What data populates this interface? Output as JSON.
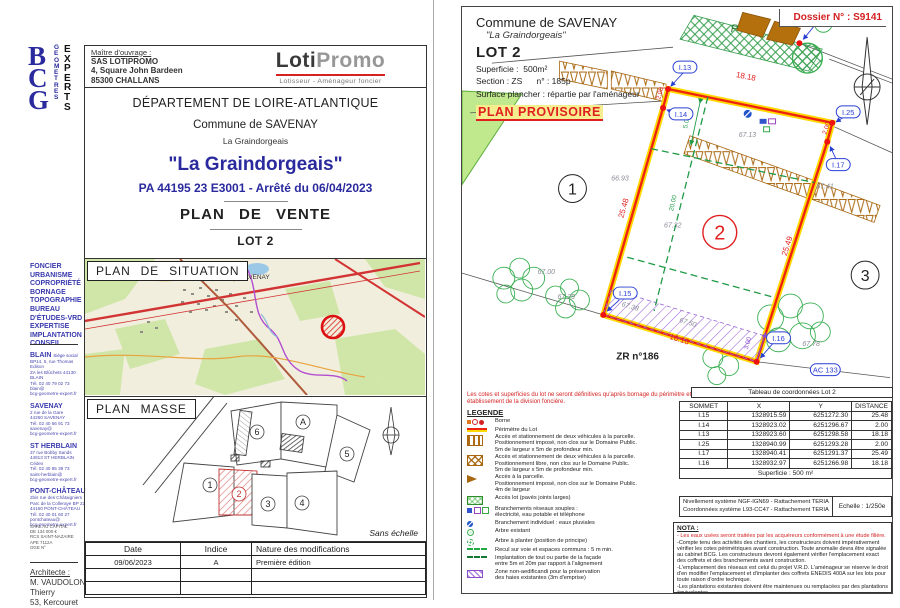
{
  "colors": {
    "accent_blue": "#2a2a9e",
    "red": "#d42222",
    "boundary_red": "#ee2211",
    "boundary_yellow": "#ffd900",
    "green": "#22a04a",
    "purple": "#8a4fc8",
    "brown": "#a8660f"
  },
  "left_page": {
    "logo": {
      "letters": "BCG",
      "geometres": "GEOMETRES",
      "experts": "EXPERTS"
    },
    "owner": {
      "label": "Maître d'ouvrage :",
      "lines": "SAS LOTIPROMO\n4, Square John Bardeen\n85300 CHALLANS"
    },
    "lotipromo": {
      "name_bold": "Loti",
      "name_light": "Promo",
      "tagline": "Lotisseur - Aménageur foncier"
    },
    "title": {
      "departement": "DÉPARTEMENT DE LOIRE-ATLANTIQUE",
      "commune": "Commune de SAVENAY",
      "lieu": "La Graindorgeais",
      "project": "\"La Graindorgeais\"",
      "permit": "PA 44195 23 E3001 - Arrêté du 06/04/2023",
      "doc_type": "PLAN DE VENTE",
      "lot": "LOT 2"
    },
    "situation": {
      "title": "PLAN DE SITUATION",
      "map_label": "SAVENAY"
    },
    "masse": {
      "title": "PLAN MASSE",
      "scale_note": "Sans échelle",
      "lot_numbers": [
        "1",
        "2",
        "3",
        "4",
        "5",
        "6",
        "A"
      ]
    },
    "mod_table": {
      "headers": [
        "Date",
        "Indice",
        "Nature des modifications"
      ],
      "rows": [
        [
          "09/06/2023",
          "A",
          "Première édition"
        ],
        [
          "",
          "",
          ""
        ],
        [
          "",
          "",
          ""
        ]
      ]
    },
    "sidebar": {
      "services": "FONCIER\nURBANISME\nCOPROPRIÉTÉ\nBORNAGE\nTOPOGRAPHIE\nBUREAU\n D'ÉTUDES-VRD\nEXPERTISE\nIMPLANTATION\nCONSEIL",
      "offices": [
        {
          "city": "BLAIN",
          "sub": "Siège social",
          "lines": "BP14, 5, rue Thomas Edison\nZA les Blûchets 44130 BLAIN\nTél. 02 40 79 02 73\nblain@\nbcg-geometre-expert.fr"
        },
        {
          "city": "SAVENAY",
          "sub": "",
          "lines": "2 rue de la Gare\n44260 SAVENAY\nTél. 02 40 56 91 73\nsavenay@\nbcg-geometre-expert.fr"
        },
        {
          "city": "ST HERBLAIN",
          "sub": "",
          "lines": "37 rue Bobby Sands\n44813 ST HERBLAIN Cédex\nTél. 02 40 95 39 73\nsaint-herblain@\nbcg-geometre-expert.fr"
        },
        {
          "city": "PONT-CHÂTEAU",
          "sub": "",
          "lines": "2bis rue des Châtaigniers\nParc de la Colleraye BP 22\n44160 PONT-CHÂTEAU\nTél. 02 40 01 60 27\npontchateau@\nbcg-geometre-expert.fr"
        }
      ],
      "legal": "SARL AU CAPITAL\nDE 134 000 €\nRCS SAINT-NAZAIRE\nAPE 7112A\nOGE N°",
      "architect": {
        "label": "Architecte :",
        "name": "M. VAUDOLON Thierry",
        "address": "53, Kercouret"
      }
    }
  },
  "right_page": {
    "dossier": "Dossier N° : S9141",
    "header": {
      "commune": "Commune de SAVENAY",
      "lieu": "\"La Graindorgeais\"",
      "lot": "LOT 2",
      "superficie": "Superficie :  500m²",
      "section": "Section : ZS      n° : 185p",
      "surface": "Surface plancher : répartie par l'aménageur",
      "provisoire": "PLAN PROVISOIRE"
    },
    "plan": {
      "labels": {
        "i3": "I.3",
        "i13": "I.13",
        "i14": "I.14",
        "i15": "I.15",
        "i16": "I.16",
        "i17": "I.17",
        "i25": "I.25",
        "zr": "ZR n°186",
        "ac": "AC 133",
        "p": "P",
        "lot1": "1",
        "lot2": "2",
        "lot3": "3"
      },
      "dims": {
        "top": "18.18",
        "left": "25.48",
        "right": "25.49",
        "bottom": "18.18",
        "small_left": "2.00",
        "small_right": "2.00",
        "recul": "5.00",
        "depth": "20.00",
        "hedge": "3.00"
      },
      "elev": {
        "lot1": "66.93",
        "top": "67.13",
        "mid": "67.32",
        "left1": "67.00",
        "left2": "67.29",
        "right1": "67.41",
        "right2": "67.78",
        "strip1": "67.38",
        "strip2": "67.50"
      }
    },
    "note_red": "Les cotes et superficies du lot ne seront définitives qu'après bornage du périmètre et établissement de la division foncière.",
    "legend": {
      "title": "LEGENDE",
      "items": [
        {
          "text": "Borne"
        },
        {
          "text": "Périmètre du Lot"
        },
        {
          "text": "Accès et stationnement de deux véhicules à la parcelle.\nPositionnement imposé, non clos sur le Domaine Public.\n5m de largeur x 5m de profondeur min."
        },
        {
          "text": "Accès et stationnement de deux véhicules à la parcelle.\nPositionnement libre, non clos sur le Domaine Public.\n5m de largeur x 5m de profondeur min."
        },
        {
          "text": "Accès à la parcelle.\nPositionnement imposé, non clos sur le Domaine Public.\n4m de largeur"
        },
        {
          "text": "Accès lot (pavés joints larges)"
        },
        {
          "text": "Branchements réseaux souples :\nélectricité, eau potable et téléphone"
        },
        {
          "text": "Branchement individuel : eaux pluviales"
        },
        {
          "text": "Arbre existant"
        },
        {
          "text": "Arbre à planter (position de principe)"
        },
        {
          "text": "Recul sur voie et espaces communs : 5 m min."
        },
        {
          "text": "Implantation de tout ou partie de la façade\nentre 5m et 20m par rapport à l'alignement"
        },
        {
          "text": "Zone non-aedificandi pour la préservation\ndes haies existantes (3m d'emprise)"
        }
      ]
    },
    "coord_table": {
      "title": "Tableau de coordonnées Lot 2",
      "headers": [
        "SOMMET",
        "X",
        "Y",
        "DISTANCE"
      ],
      "rows": [
        [
          "I.15",
          "1328915.59",
          "6251272.30",
          "25.48"
        ],
        [
          "I.14",
          "1328923.02",
          "6251296.67",
          "2.00"
        ],
        [
          "I.13",
          "1328923.60",
          "6251298.58",
          "18.18"
        ],
        [
          "I.25",
          "1328940.99",
          "6251293.28",
          "2.00"
        ],
        [
          "I.17",
          "1328940.41",
          "6251291.37",
          "25.49"
        ],
        [
          "I.16",
          "1328932.97",
          "6251266.98",
          "18.18"
        ]
      ],
      "footer": "Superficie : 500 m²"
    },
    "ref_box": {
      "line1": "Nivellement système NGF-IGN69 - Rattachement TERIA",
      "line2": "Coordonnées système L93-CC47  - Rattachement TERIA",
      "scale": "Echelle : 1/250e"
    },
    "nota": {
      "title": "NOTA :",
      "red_item": "- Les eaux usées seront traitées par les acquéreurs conformément à une étude filière.",
      "items": [
        "-Compte tenu des activités des chantiers, les constructeurs doivent impérativement vérifier les cotes périmétriques avant construction. Toute anomalie devra être signalée au cabinet BCG. Les constructeurs devront également vérifier l'emplacement exact des coffrets et des branchements avant construction.",
        "-L'emplacement des réseaux est celui du projet V.R.D. L'aménageur se réserve le droit d'en modifier l'emplacement et d'implanter des coffrets ENEDIS 400A sur les lots pour toute raison d'ordre technique.",
        "-Les plantations existantes doivent être maintenues ou remplacées par des plantations équivalentes.",
        "-Depuis le 1er octobre 2020, toute vente d'un terrain à bâtir se trouvant dans une zone à"
      ]
    }
  }
}
